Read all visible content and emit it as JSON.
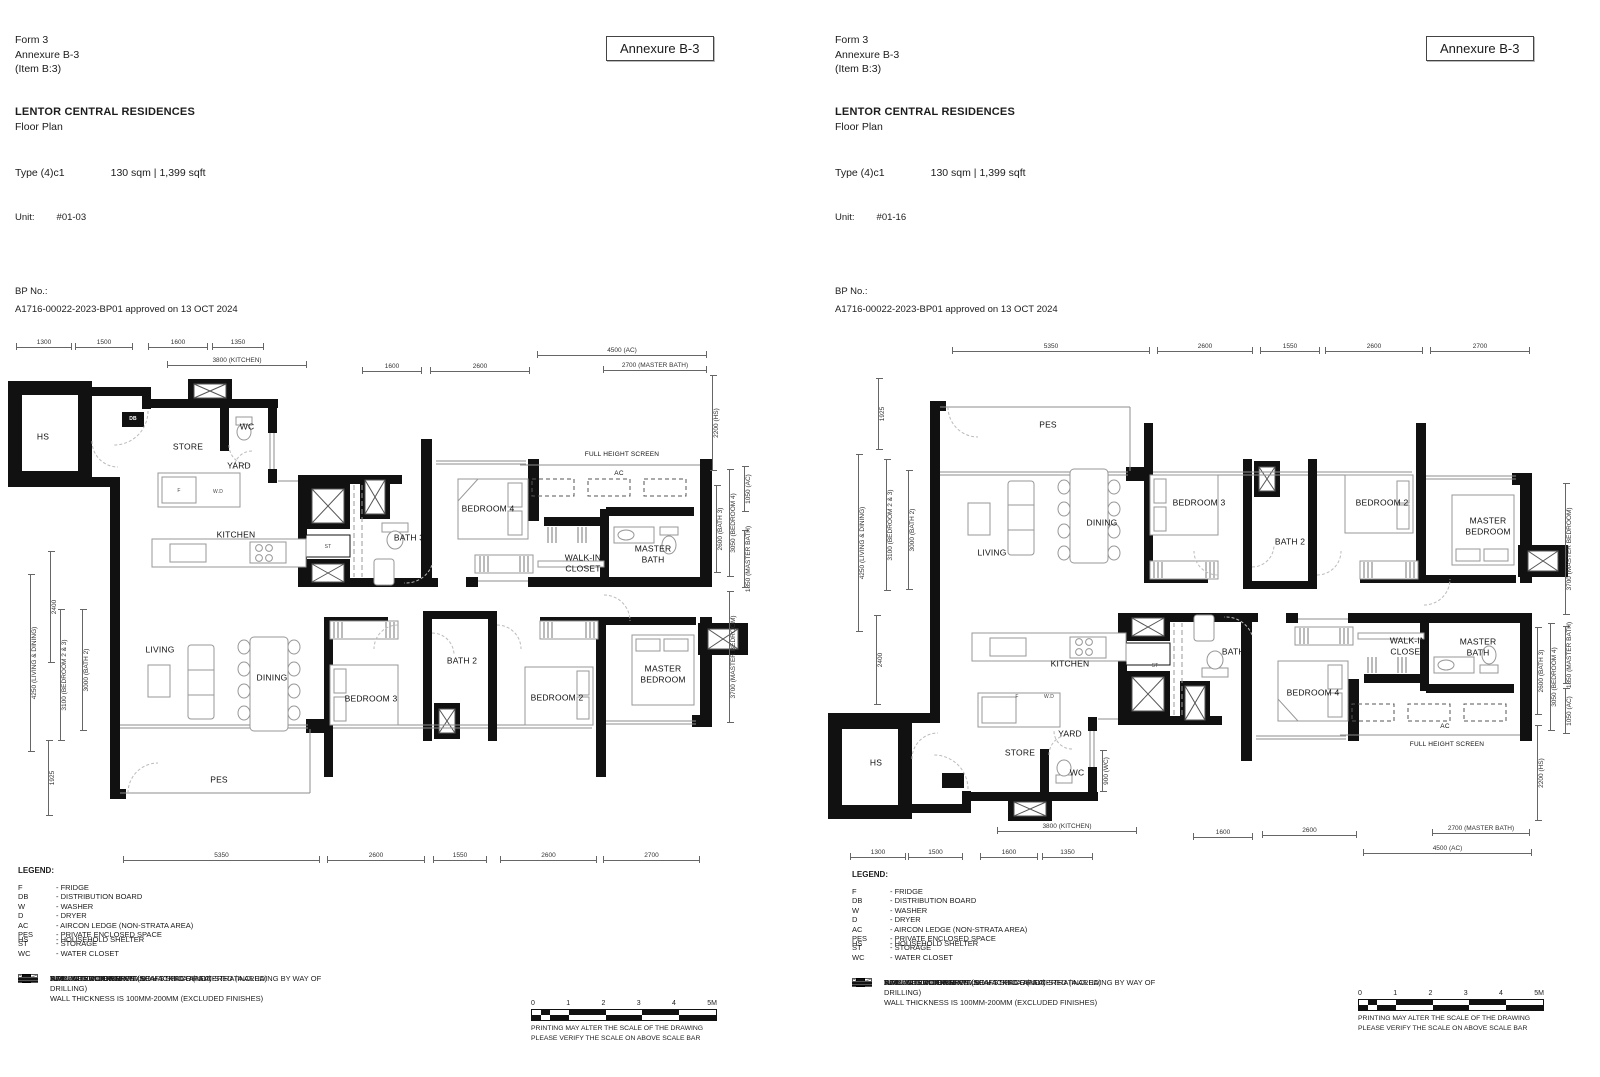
{
  "shared": {
    "form_lines": [
      "Form 3",
      "Annexure B-3",
      "(Item B:3)"
    ],
    "annexure_box": "Annexure B-3",
    "project": "LENTOR CENTRAL RESIDENCES",
    "subtitle": "Floor Plan",
    "type_label": "Type (4)c1",
    "area": "130 sqm | 1,399 sqft",
    "unit_label": "Unit:",
    "bp_label": "BP No.:",
    "bp_value": "A1716-00022-2023-BP01 approved on 13 OCT 2024",
    "legend": {
      "title": "LEGEND:",
      "abbrevs": [
        {
          "abbr": "F",
          "desc": "- FRIDGE"
        },
        {
          "abbr": "DB",
          "desc": "- DISTRIBUTION BOARD"
        },
        {
          "abbr": "W",
          "desc": "- WASHER"
        },
        {
          "abbr": "D",
          "desc": "- DRYER"
        },
        {
          "abbr": "AC",
          "desc": "- AIRCON LEDGE (NON-STRATA AREA)"
        },
        {
          "abbr": "HS",
          "desc": "- HOUSEHOLD SHELTER",
          "cls": "gap"
        },
        {
          "abbr": "PES",
          "desc": "- PRIVATE ENCLOSED SPACE"
        },
        {
          "abbr": "ST",
          "desc": "- STORAGE"
        },
        {
          "abbr": "WC",
          "desc": "- WATER CLOSET"
        }
      ],
      "symbols": [
        {
          "cls": "sym-ac",
          "text": "AIRCON CONDENSER"
        },
        {
          "cls": "sym-void",
          "text": "SERVICES VOID SPACE (NON-STRATA AREA)"
        },
        {
          "cls": "sym-rwdp",
          "text": "RAINWATER DOWNPIPE SHAFT SPACE (NON-STRATA AREA)"
        },
        {
          "cls": "sym-wall",
          "text": "WALL NOT ALLOWED TO BE HACKED OR ALTERED (INCLUDING BY WAY OF DRILLING)\nWALL THICKNESS IS 100MM-200MM (EXCLUDED FINISHES)"
        },
        {
          "cls": "sym-ns",
          "text": "NON - STRUCTURAL WALL"
        }
      ]
    },
    "scalebar": {
      "labels": [
        "0",
        "1",
        "2",
        "3",
        "4",
        "5M"
      ],
      "note1": "PRINTING MAY ALTER THE SCALE OF THE DRAWING",
      "note2": "PLEASE VERIFY THE SCALE ON ABOVE SCALE BAR"
    }
  },
  "left": {
    "unit": "#01-03",
    "rooms": [
      {
        "text": "HS",
        "left": 43,
        "top": 104
      },
      {
        "text": "STORE",
        "left": 188,
        "top": 114
      },
      {
        "text": "WC",
        "left": 247,
        "top": 94
      },
      {
        "text": "YARD",
        "left": 239,
        "top": 133
      },
      {
        "text": "KITCHEN",
        "left": 236,
        "top": 202
      },
      {
        "text": "BATH 3",
        "left": 409,
        "top": 205
      },
      {
        "text": "BEDROOM 4",
        "left": 488,
        "top": 176
      },
      {
        "text": "WALK-IN\nCLOSET",
        "left": 583,
        "top": 230
      },
      {
        "text": "MASTER\nBATH",
        "left": 653,
        "top": 221
      },
      {
        "text": "AC",
        "left": 619,
        "top": 141,
        "cls": "small"
      },
      {
        "text": "FULL HEIGHT SCREEN",
        "left": 622,
        "top": 122,
        "cls": "small"
      },
      {
        "text": "LIVING",
        "left": 160,
        "top": 317
      },
      {
        "text": "DINING",
        "left": 272,
        "top": 345
      },
      {
        "text": "BEDROOM 3",
        "left": 371,
        "top": 366
      },
      {
        "text": "BATH 2",
        "left": 462,
        "top": 328
      },
      {
        "text": "BEDROOM 2",
        "left": 557,
        "top": 365
      },
      {
        "text": "MASTER\nBEDROOM",
        "left": 663,
        "top": 341
      },
      {
        "text": "PES",
        "left": 219,
        "top": 447
      },
      {
        "text": "F",
        "left": 179,
        "top": 158,
        "cls": "tiny"
      },
      {
        "text": "W.D",
        "left": 218,
        "top": 159,
        "cls": "tiny"
      },
      {
        "text": "DB",
        "left": 133,
        "top": 86,
        "cls": "tiny-inv"
      },
      {
        "text": "ST",
        "left": 328,
        "top": 214,
        "cls": "tiny"
      }
    ],
    "dims": [
      {
        "text": "1300",
        "cls": "dimh",
        "left": 16,
        "top": 4,
        "width": 56
      },
      {
        "text": "1500",
        "cls": "dimh",
        "left": 75,
        "top": 4,
        "width": 58
      },
      {
        "text": "1600",
        "cls": "dimh",
        "left": 148,
        "top": 4,
        "width": 60
      },
      {
        "text": "1350",
        "cls": "dimh",
        "left": 212,
        "top": 4,
        "width": 52
      },
      {
        "text": "3800 (KITCHEN)",
        "cls": "dimh",
        "left": 167,
        "top": 22,
        "width": 140
      },
      {
        "text": "1600",
        "cls": "dimh",
        "left": 362,
        "top": 28,
        "width": 60
      },
      {
        "text": "2600",
        "cls": "dimh",
        "left": 430,
        "top": 28,
        "width": 100
      },
      {
        "text": "4500 (AC)",
        "cls": "dimh",
        "left": 537,
        "top": 12,
        "width": 170
      },
      {
        "text": "2700 (MASTER BATH)",
        "cls": "dimh",
        "left": 603,
        "top": 27,
        "width": 104
      },
      {
        "text": "5350",
        "cls": "dimh",
        "left": 123,
        "top": 517,
        "width": 197
      },
      {
        "text": "2600",
        "cls": "dimh",
        "left": 327,
        "top": 517,
        "width": 98
      },
      {
        "text": "1550",
        "cls": "dimh",
        "left": 433,
        "top": 517,
        "width": 54
      },
      {
        "text": "2600",
        "cls": "dimh",
        "left": 500,
        "top": 517,
        "width": 97
      },
      {
        "text": "2700",
        "cls": "dimh",
        "left": 603,
        "top": 517,
        "width": 97
      },
      {
        "text": "2400",
        "cls": "dimv",
        "left": 50,
        "top": 218,
        "height": 112
      },
      {
        "text": "4250 (LIVING & DINING)",
        "cls": "dimv",
        "left": 30,
        "top": 241,
        "height": 178
      },
      {
        "text": "3100 (BEDROOM 2 & 3)",
        "cls": "dimv",
        "left": 60,
        "top": 276,
        "height": 132
      },
      {
        "text": "3000 (BATH 2)",
        "cls": "dimv",
        "left": 82,
        "top": 276,
        "height": 122
      },
      {
        "text": "1925",
        "cls": "dimv",
        "left": 48,
        "top": 407,
        "height": 76
      },
      {
        "text": "2200 (HS)",
        "cls": "dimv",
        "left": 712,
        "top": 42,
        "height": 96
      },
      {
        "text": "1050 (AC)",
        "cls": "dimv",
        "left": 744,
        "top": 133,
        "height": 46
      },
      {
        "text": "2600 (BATH 3)",
        "cls": "dimv",
        "left": 716,
        "top": 152,
        "height": 88
      },
      {
        "text": "3050 (BEDROOM 4)",
        "cls": "dimv",
        "left": 729,
        "top": 136,
        "height": 108
      },
      {
        "text": "1850 (MASTER BATH)",
        "cls": "dimv",
        "left": 744,
        "top": 197,
        "height": 58
      },
      {
        "text": "3700 (MASTER BEDROOM)",
        "cls": "dimv",
        "left": 729,
        "top": 258,
        "height": 132
      }
    ]
  },
  "right": {
    "unit": "#01-16",
    "rooms": [
      {
        "text": "PES",
        "left": 228,
        "top": 88
      },
      {
        "text": "LIVING",
        "left": 172,
        "top": 216
      },
      {
        "text": "DINING",
        "left": 282,
        "top": 186
      },
      {
        "text": "BEDROOM 3",
        "left": 379,
        "top": 166
      },
      {
        "text": "BATH 2",
        "left": 470,
        "top": 205
      },
      {
        "text": "BEDROOM 2",
        "left": 562,
        "top": 166
      },
      {
        "text": "MASTER\nBEDROOM",
        "left": 668,
        "top": 189
      },
      {
        "text": "KITCHEN",
        "left": 250,
        "top": 327
      },
      {
        "text": "YARD",
        "left": 250,
        "top": 397
      },
      {
        "text": "STORE",
        "left": 200,
        "top": 416
      },
      {
        "text": "WC",
        "left": 257,
        "top": 436
      },
      {
        "text": "HS",
        "left": 56,
        "top": 426
      },
      {
        "text": "BATH 3",
        "left": 417,
        "top": 315
      },
      {
        "text": "BEDROOM 4",
        "left": 493,
        "top": 356
      },
      {
        "text": "WALK-IN\nCLOSET",
        "left": 588,
        "top": 309
      },
      {
        "text": "MASTER\nBATH",
        "left": 658,
        "top": 310
      },
      {
        "text": "AC",
        "left": 625,
        "top": 390,
        "cls": "small"
      },
      {
        "text": "FULL HEIGHT SCREEN",
        "left": 627,
        "top": 408,
        "cls": "small"
      },
      {
        "text": "F",
        "left": 197,
        "top": 360,
        "cls": "tiny"
      },
      {
        "text": "W.D",
        "left": 229,
        "top": 360,
        "cls": "tiny"
      },
      {
        "text": "DB",
        "left": 151,
        "top": 437,
        "cls": "tiny-inv"
      },
      {
        "text": "ST",
        "left": 335,
        "top": 329,
        "cls": "tiny"
      }
    ],
    "dims": [
      {
        "text": "5350",
        "cls": "dimh",
        "left": 132,
        "top": 4,
        "width": 198
      },
      {
        "text": "2600",
        "cls": "dimh",
        "left": 337,
        "top": 4,
        "width": 96
      },
      {
        "text": "1550",
        "cls": "dimh",
        "left": 440,
        "top": 4,
        "width": 60
      },
      {
        "text": "2600",
        "cls": "dimh",
        "left": 505,
        "top": 4,
        "width": 98
      },
      {
        "text": "2700",
        "cls": "dimh",
        "left": 610,
        "top": 4,
        "width": 100
      },
      {
        "text": "1925",
        "cls": "dimv",
        "left": 58,
        "top": 41,
        "height": 72
      },
      {
        "text": "4250 (LIVING & DINING)",
        "cls": "dimv",
        "left": 38,
        "top": 117,
        "height": 178
      },
      {
        "text": "3100 (BEDROOM 2 & 3)",
        "cls": "dimv",
        "left": 66,
        "top": 122,
        "height": 132
      },
      {
        "text": "3000 (BATH 2)",
        "cls": "dimv",
        "left": 88,
        "top": 133,
        "height": 120
      },
      {
        "text": "2400",
        "cls": "dimv",
        "left": 56,
        "top": 278,
        "height": 90
      },
      {
        "text": "3700 (MASTER BEDROOM)",
        "cls": "dimv",
        "left": 745,
        "top": 146,
        "height": 132
      },
      {
        "text": "2600 (BATH 3)",
        "cls": "dimv",
        "left": 717,
        "top": 290,
        "height": 88
      },
      {
        "text": "3050 (BEDROOM 4)",
        "cls": "dimv",
        "left": 730,
        "top": 286,
        "height": 108
      },
      {
        "text": "1850 (MASTER BATH)",
        "cls": "dimv",
        "left": 745,
        "top": 289,
        "height": 58
      },
      {
        "text": "1050 (AC)",
        "cls": "dimv",
        "left": 745,
        "top": 351,
        "height": 46
      },
      {
        "text": "2200 (HS)",
        "cls": "dimv",
        "left": 717,
        "top": 388,
        "height": 96
      },
      {
        "text": "900 (WC)",
        "cls": "dimv",
        "left": 282,
        "top": 413,
        "height": 42
      },
      {
        "text": "3800 (KITCHEN)",
        "cls": "dimh",
        "left": 177,
        "top": 484,
        "width": 140
      },
      {
        "text": "1300",
        "cls": "dimh",
        "left": 30,
        "top": 510,
        "width": 56
      },
      {
        "text": "1500",
        "cls": "dimh",
        "left": 88,
        "top": 510,
        "width": 55
      },
      {
        "text": "1600",
        "cls": "dimh",
        "left": 160,
        "top": 510,
        "width": 58
      },
      {
        "text": "1350",
        "cls": "dimh",
        "left": 222,
        "top": 510,
        "width": 51
      },
      {
        "text": "1600",
        "cls": "dimh",
        "left": 373,
        "top": 490,
        "width": 60
      },
      {
        "text": "2600",
        "cls": "dimh",
        "left": 442,
        "top": 488,
        "width": 95
      },
      {
        "text": "2700 (MASTER BATH)",
        "cls": "dimh",
        "left": 612,
        "top": 486,
        "width": 98
      },
      {
        "text": "4500 (AC)",
        "cls": "dimh",
        "left": 543,
        "top": 506,
        "width": 169
      }
    ]
  }
}
